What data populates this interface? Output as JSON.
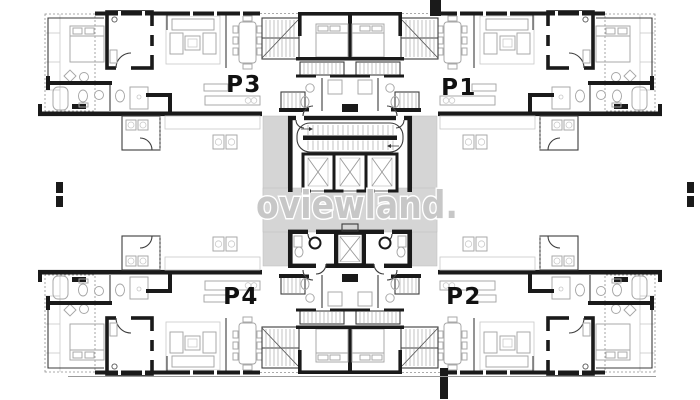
{
  "units": [
    {
      "label": "P3"
    },
    {
      "label": "P1"
    },
    {
      "label": "P4"
    },
    {
      "label": "P2"
    }
  ],
  "watermark": {
    "text": "oviewland."
  },
  "colors": {
    "wall": "#1a1a1a",
    "furn": "#a6a6a6",
    "lite": "#c9c9c9",
    "corridor": "#d5d5d5",
    "wm": "#c7c7c7",
    "label": "#111111"
  }
}
